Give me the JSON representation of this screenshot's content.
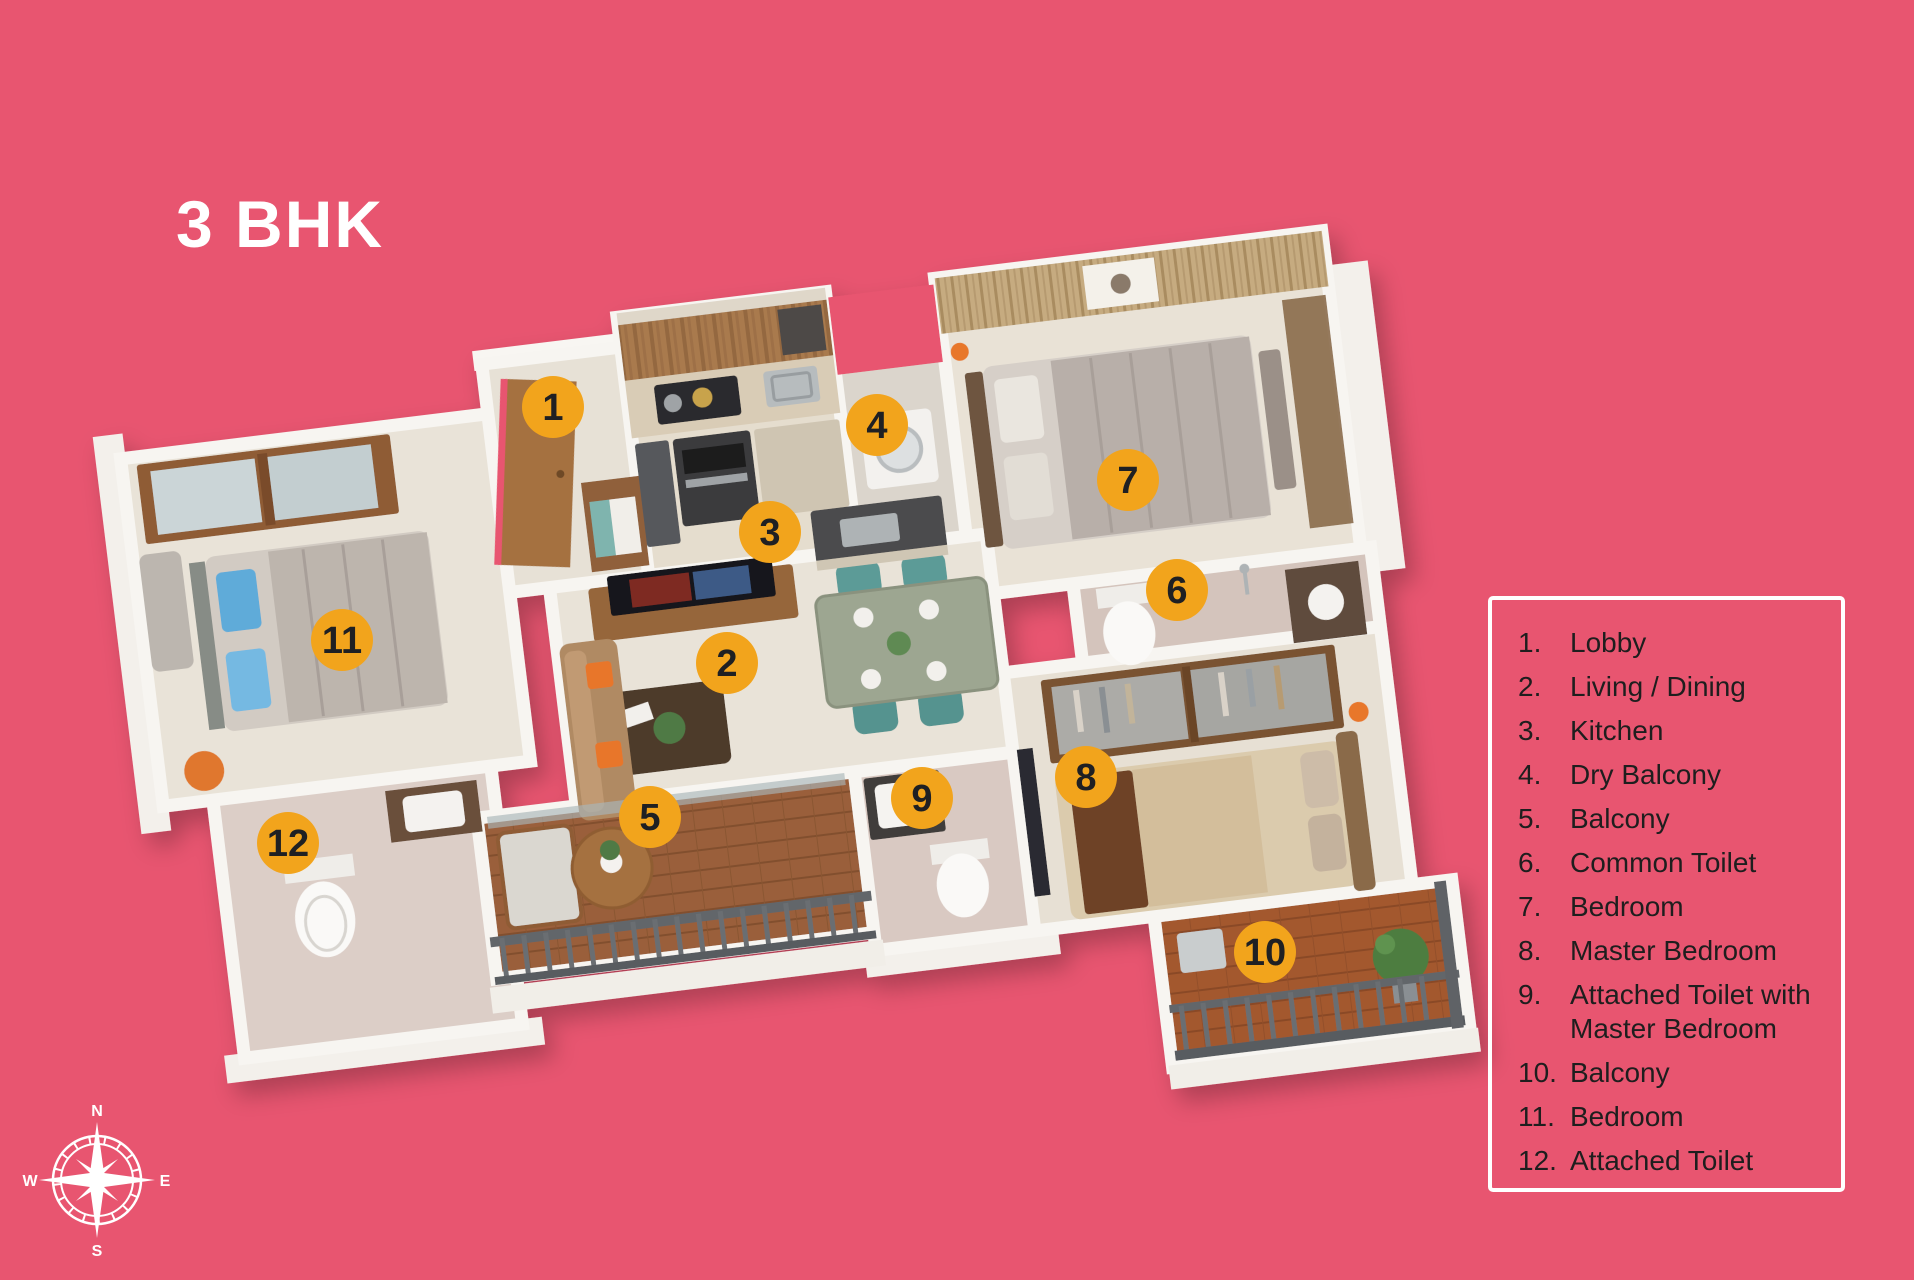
{
  "title": "3 BHK",
  "legend": {
    "items": [
      {
        "num": "1.",
        "label": "Lobby"
      },
      {
        "num": "2.",
        "label": "Living / Dining"
      },
      {
        "num": "3.",
        "label": "Kitchen"
      },
      {
        "num": "4.",
        "label": "Dry Balcony"
      },
      {
        "num": "5.",
        "label": "Balcony"
      },
      {
        "num": "6.",
        "label": "Common Toilet"
      },
      {
        "num": "7.",
        "label": "Bedroom"
      },
      {
        "num": "8.",
        "label": "Master Bedroom"
      },
      {
        "num": "9.",
        "label": "Attached Toilet with Master Bedroom"
      },
      {
        "num": "10.",
        "label": "Balcony"
      },
      {
        "num": "11.",
        "label": "Bedroom"
      },
      {
        "num": "12.",
        "label": "Attached Toilet"
      }
    ]
  },
  "markers": [
    {
      "label": "1"
    },
    {
      "label": "2"
    },
    {
      "label": "3"
    },
    {
      "label": "4"
    },
    {
      "label": "5"
    },
    {
      "label": "6"
    },
    {
      "label": "7"
    },
    {
      "label": "8"
    },
    {
      "label": "9"
    },
    {
      "label": "10"
    },
    {
      "label": "11"
    },
    {
      "label": "12"
    }
  ],
  "compass": {
    "n": "N",
    "e": "E",
    "s": "S",
    "w": "W"
  },
  "colors": {
    "background": "#e85570",
    "marker_fill": "#f2a41c",
    "marker_text": "#1f2023",
    "legend_border": "#ffffff",
    "legend_text": "#1e1e1e",
    "title_text": "#ffffff"
  }
}
